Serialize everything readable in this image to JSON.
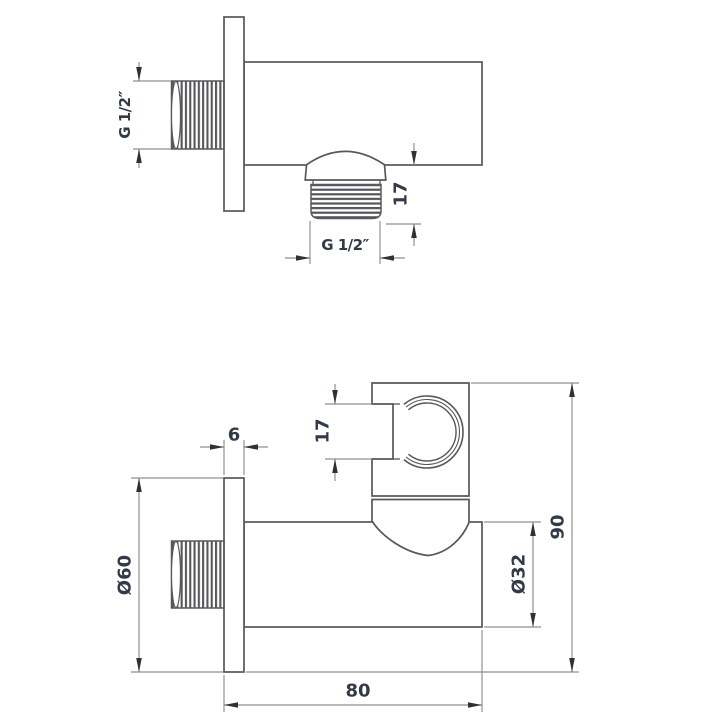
{
  "drawing": {
    "type": "technical-dimension-drawing",
    "views": {
      "top_view": {
        "side_thread_label": "G 1/2″",
        "outlet_thread_label": "G 1/2″",
        "outlet_height_label": "17"
      },
      "front_view": {
        "plate_thickness_label": "6",
        "holder_slot_label": "17",
        "flange_diameter_label": "Ø60",
        "body_diameter_label": "Ø32",
        "overall_height_label": "90",
        "overall_depth_label": "80"
      }
    },
    "colors": {
      "line": "#56585c",
      "dim": "#8e9194",
      "arrow": "#2e3135",
      "text": "#323947",
      "thread": "#55575b",
      "background": "#ffffff"
    }
  }
}
